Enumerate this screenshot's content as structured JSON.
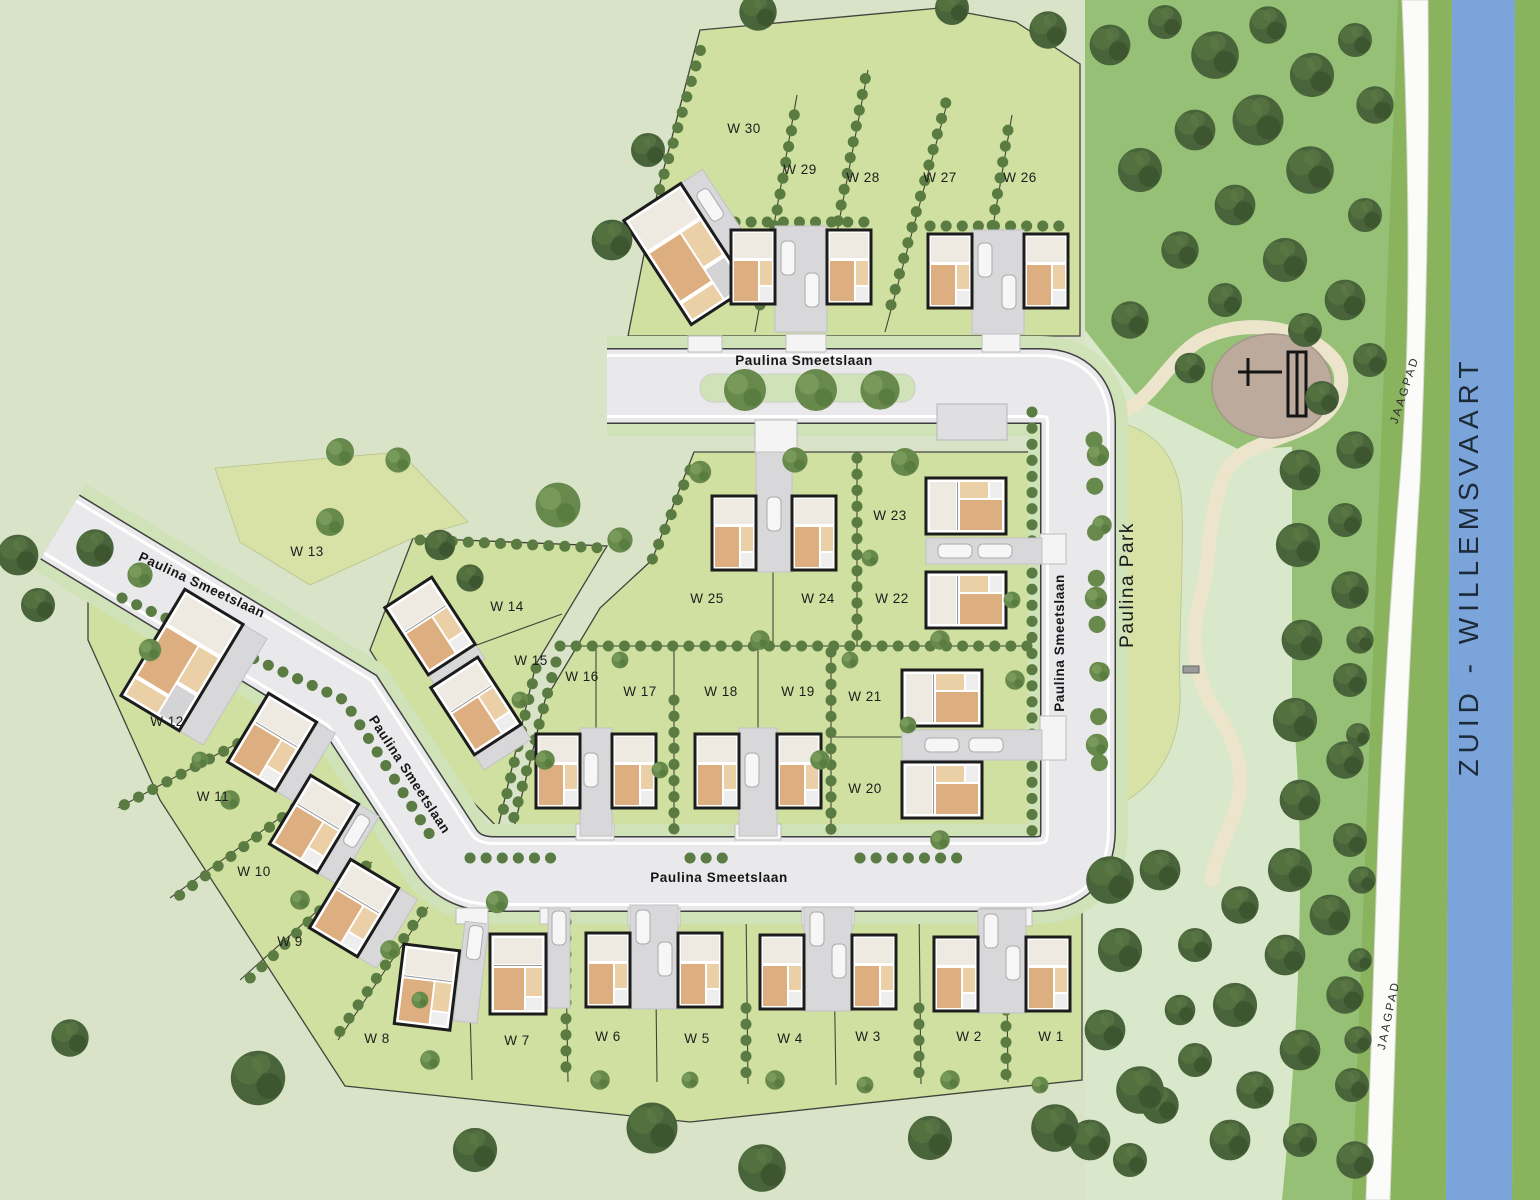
{
  "canal": {
    "label": "ZUID - WILLEMSVAART"
  },
  "towpath": {
    "label": "JAAGPAD"
  },
  "park": {
    "label": "Paulina Park"
  },
  "street": {
    "label": "Paulina Smeetslaan"
  },
  "plots": [
    {
      "label": "W 1"
    },
    {
      "label": "W 2"
    },
    {
      "label": "W 3"
    },
    {
      "label": "W 4"
    },
    {
      "label": "W 5"
    },
    {
      "label": "W 6"
    },
    {
      "label": "W 7"
    },
    {
      "label": "W 8"
    },
    {
      "label": "W 9"
    },
    {
      "label": "W 10"
    },
    {
      "label": "W 11"
    },
    {
      "label": "W 12"
    },
    {
      "label": "W 13"
    },
    {
      "label": "W 14"
    },
    {
      "label": "W 15"
    },
    {
      "label": "W 16"
    },
    {
      "label": "W 17"
    },
    {
      "label": "W 18"
    },
    {
      "label": "W 19"
    },
    {
      "label": "W 20"
    },
    {
      "label": "W 21"
    },
    {
      "label": "W 22"
    },
    {
      "label": "W 23"
    },
    {
      "label": "W 24"
    },
    {
      "label": "W 25"
    },
    {
      "label": "W 26"
    },
    {
      "label": "W 27"
    },
    {
      "label": "W 28"
    },
    {
      "label": "W 29"
    },
    {
      "label": "W 30"
    }
  ],
  "colors": {
    "bg": "#d8e3c8",
    "parcel": "#cfe0a0",
    "meadow": "#d8e1a6",
    "verge": "#cfe2b8",
    "road": "#e9e9ec",
    "roadEdge": "#3f3f3f",
    "parkPale": "#d9e8cb",
    "parkGreen": "#96c076",
    "path": "#ede5cb",
    "playground": "#bcab9c",
    "canal": "#7ba4da",
    "bank": "#8ab35e",
    "drive": "#d8d8db",
    "houseWall": "#ffffff",
    "houseLine": "#1c1c1c",
    "roof": "#eeeae2",
    "wood": "#dcae80",
    "woodLight": "#ebcfa6",
    "label": "#1d1d1d",
    "canalText": "#1d2a38",
    "treeDark": "#49633a",
    "treeMid": "#67894b",
    "bush": "#5a7b41",
    "cross": "#f4f4f4",
    "parking": "#dfdfe2"
  }
}
